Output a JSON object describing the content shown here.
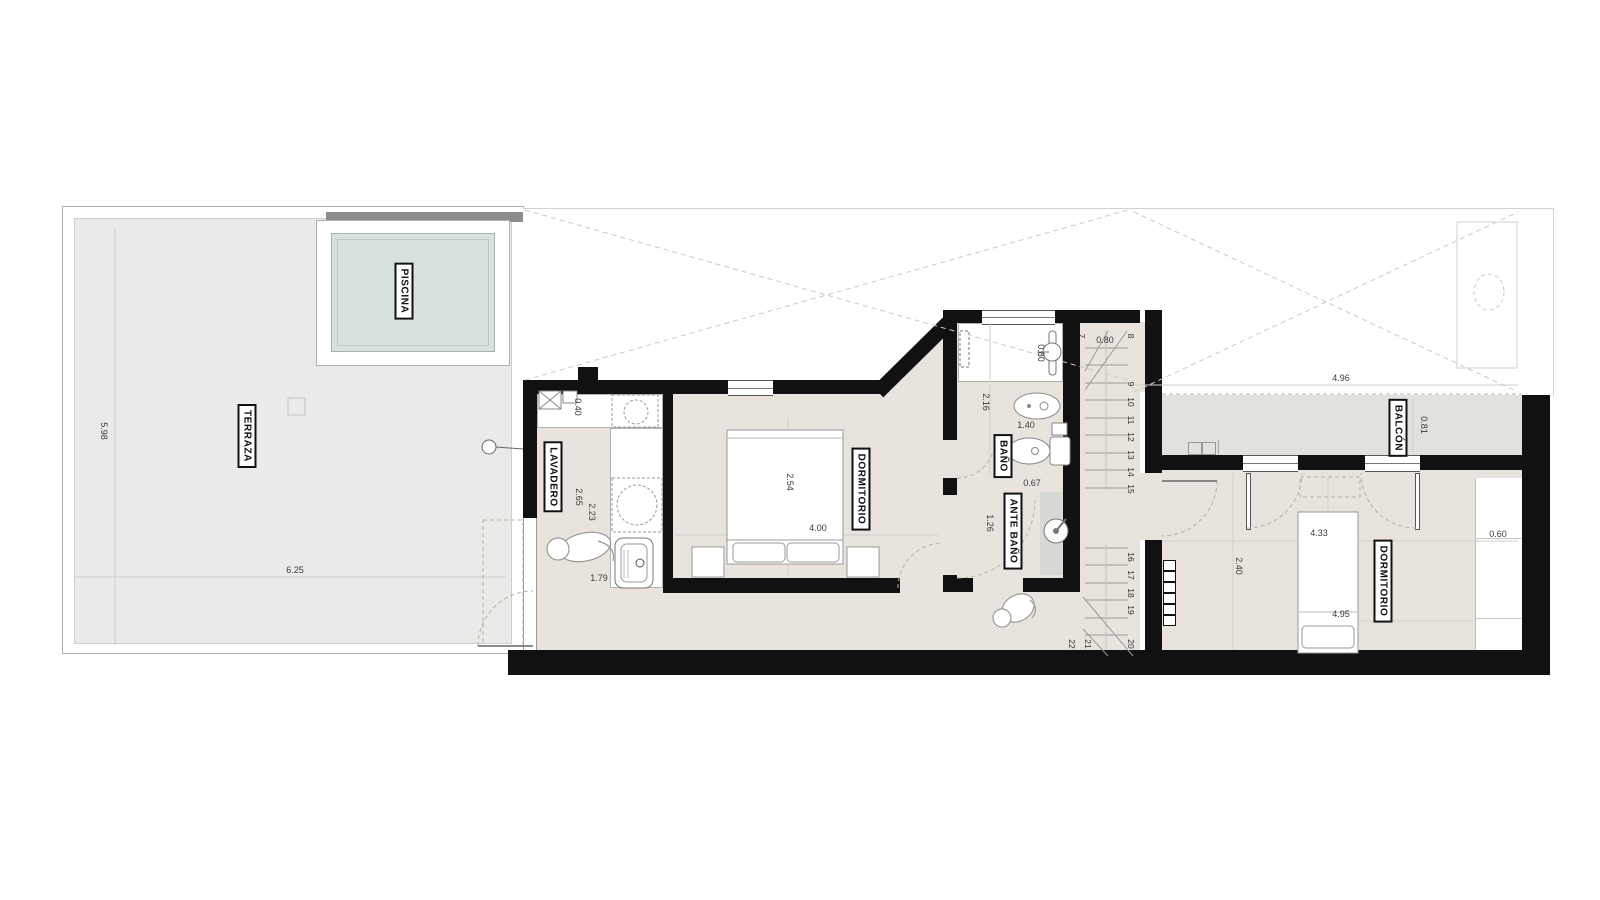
{
  "colors": {
    "wall": "#111111",
    "floor": "#e8e4dd",
    "terrace": "#eaeae8",
    "balcony": "#e1e1de",
    "pool_water": "#d7e1de",
    "shower_gray": "#d8d8d5"
  },
  "rooms": {
    "terraza": "TERRAZA",
    "piscina": "PISCINA",
    "lavadero": "LAVADERO",
    "dormitorio_1": "DORMITORIO",
    "bano": "BAÑO",
    "ante_bano": "ANTE BAÑO",
    "balcon": "BALCÓN",
    "dormitorio_2": "DORMITORIO"
  },
  "dims": {
    "terraza_h": "5.98",
    "terraza_w": "6.25",
    "lav_counter": "0.40",
    "lav_d1": "2.65",
    "lav_d2": "2.23",
    "lav_w": "1.79",
    "dorm1_w": "2.54",
    "dorm1_l": "4.00",
    "bano_vanity": "0.80",
    "bano_d1": "2.16",
    "bano_d2": "1.40",
    "ante_d1": "0.67",
    "ante_d2": "1.26",
    "stair_w": "0.80",
    "balcon_l": "4.96",
    "balcon_w": "0.81",
    "dorm2_d1": "2.40",
    "dorm2_bed": "4.33",
    "dorm2_l": "4.95",
    "closet_w": "0.60"
  },
  "stairs": {
    "steps": [
      "7",
      "8",
      "9",
      "10",
      "11",
      "12",
      "13",
      "14",
      "15",
      "16",
      "17",
      "18",
      "19",
      "20",
      "21",
      "22"
    ]
  }
}
